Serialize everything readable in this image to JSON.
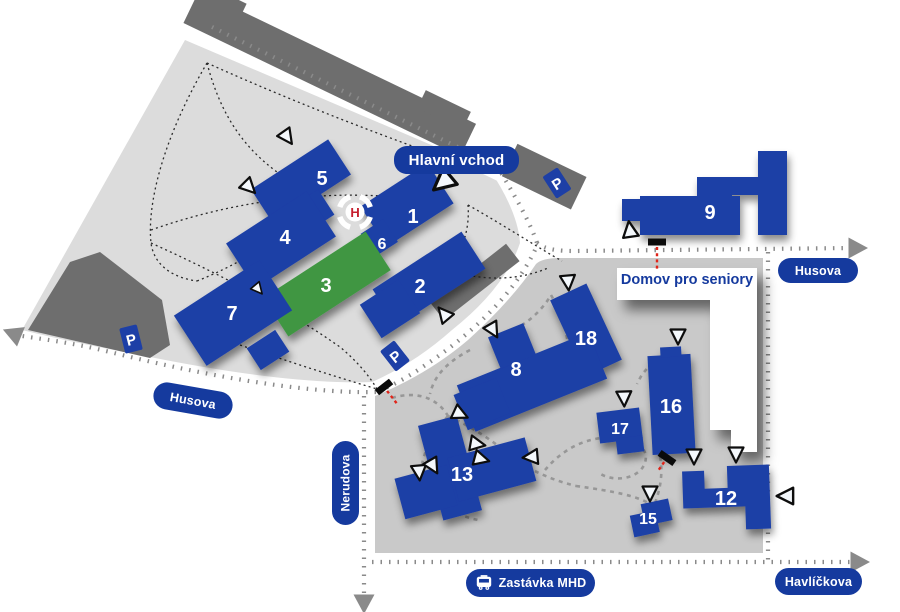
{
  "map": {
    "labels": {
      "main_entrance": "Hlavní vchod",
      "seniors_home": "Domov pro seniory",
      "bus_stop": "Zastávka MHD",
      "parking": "P",
      "helipad": "H"
    },
    "streets": {
      "husova_left": "Husova",
      "husova_right": "Husova",
      "nerudova": "Nerudova",
      "havlickova": "Havlíčkova"
    },
    "buildings": {
      "b1": "1",
      "b2": "2",
      "b3": "3",
      "b4": "4",
      "b5": "5",
      "b6": "6",
      "b7": "7",
      "b8": "8",
      "b9": "9",
      "b12": "12",
      "b13": "13",
      "b15": "15",
      "b16": "16",
      "b17": "17",
      "b18": "18"
    },
    "colors": {
      "building_blue": "#1d3fa6",
      "building_green": "#3f9643",
      "campus_left": "#dcdcdc",
      "campus_right": "#c9c9c9",
      "road_dark": "#6e6e6e",
      "street_dots": "#8a8a8a",
      "pill_blue": "#153a9e",
      "gate_red": "#e02419",
      "helipad_red": "#c61f2e"
    },
    "entrances": [
      {
        "x": 287,
        "y": 137,
        "rot": 145,
        "s": 1
      },
      {
        "x": 249,
        "y": 187,
        "rot": 135,
        "s": 1
      },
      {
        "x": 443,
        "y": 182,
        "rot": -130,
        "s": 1.45
      },
      {
        "x": 630,
        "y": 230,
        "rot": -8,
        "s": 1.05
      },
      {
        "x": 568,
        "y": 282,
        "rot": 175,
        "s": 1
      },
      {
        "x": 444,
        "y": 314,
        "rot": -40,
        "s": 1
      },
      {
        "x": 493,
        "y": 330,
        "rot": 150,
        "s": 1
      },
      {
        "x": 258,
        "y": 289,
        "rot": 140,
        "s": 0.75
      },
      {
        "x": 460,
        "y": 414,
        "rot": 115,
        "s": 1
      },
      {
        "x": 477,
        "y": 444,
        "rot": 100,
        "s": 1
      },
      {
        "x": 481,
        "y": 459,
        "rot": 105,
        "s": 1
      },
      {
        "x": 419,
        "y": 472,
        "rot": 175,
        "s": 1
      },
      {
        "x": 433,
        "y": 466,
        "rot": 150,
        "s": 1
      },
      {
        "x": 531,
        "y": 457,
        "rot": -95,
        "s": 1
      },
      {
        "x": 624,
        "y": 398,
        "rot": 178,
        "s": 1
      },
      {
        "x": 678,
        "y": 336,
        "rot": 180,
        "s": 1
      },
      {
        "x": 694,
        "y": 456,
        "rot": 180,
        "s": 1
      },
      {
        "x": 736,
        "y": 454,
        "rot": 180,
        "s": 1
      },
      {
        "x": 650,
        "y": 493,
        "rot": 180,
        "s": 1
      },
      {
        "x": 786,
        "y": 496,
        "rot": -90,
        "s": 1.1
      }
    ],
    "gates": [
      {
        "x": 657,
        "y": 242,
        "rot": 0,
        "len": 24
      },
      {
        "x": 384,
        "y": 387,
        "rot": -38,
        "len": 16
      },
      {
        "x": 667,
        "y": 458,
        "rot": 35,
        "len": 10
      }
    ],
    "street_arrows": [
      {
        "x": 14,
        "y": 334,
        "rot": -68
      },
      {
        "x": 856,
        "y": 248,
        "rot": 90
      },
      {
        "x": 364,
        "y": 602,
        "rot": 180
      },
      {
        "x": 858,
        "y": 562,
        "rot": 90
      }
    ]
  }
}
